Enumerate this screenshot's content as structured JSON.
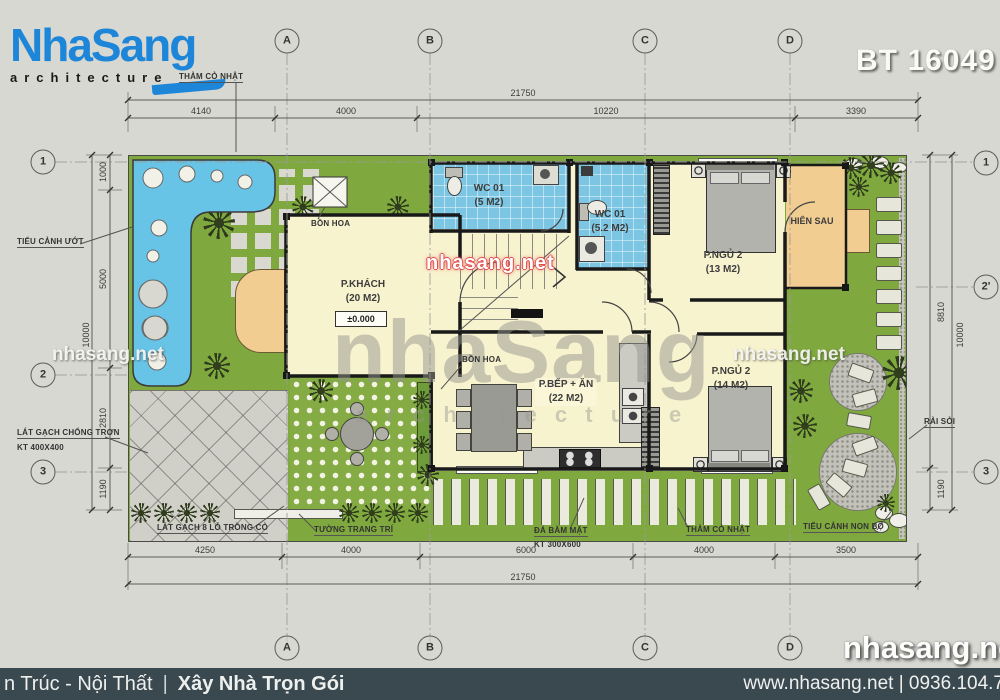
{
  "header": {
    "brand": "NhaSang",
    "brand_tagline": "architecture",
    "project_code": "BT 16049"
  },
  "grid": {
    "top": [
      "A",
      "B",
      "C",
      "D"
    ],
    "bottom": [
      "A",
      "B",
      "C",
      "D"
    ],
    "left": [
      "1",
      "2",
      "3"
    ],
    "right": [
      "1",
      "2'",
      "3"
    ]
  },
  "dimensions": {
    "top_overall": "21750",
    "top_segments": [
      "4140",
      "4000",
      "10220",
      "3390"
    ],
    "bottom_overall": "21750",
    "bottom_segments": [
      "4250",
      "4000",
      "6000",
      "4000",
      "3500"
    ],
    "left_overall": "10000",
    "left_segments": [
      "1000",
      "5000",
      "2810",
      "1190"
    ],
    "right_overall": "10000",
    "right_segments": [
      "8810",
      "1190"
    ]
  },
  "rooms": {
    "living": {
      "name": "P.KHÁCH",
      "area": "(20 M2)",
      "level": "±0.000"
    },
    "wc1": {
      "name": "WC 01",
      "area": "(5 M2)"
    },
    "wc2": {
      "name": "WC 01",
      "area": "(5.2 M2)"
    },
    "bed1": {
      "name": "P.NGỦ 2",
      "area": "(13 M2)"
    },
    "bed2": {
      "name": "P.NGỦ 2",
      "area": "(14 M2)"
    },
    "kitchen": {
      "name": "P.BẾP + ĂN",
      "area": "(22 M2)"
    },
    "porch": {
      "name": "HIÊN SAU"
    },
    "planter_top": {
      "name": "BỒN HOA"
    },
    "planter_kitchen": {
      "name": "BỒN HOA"
    }
  },
  "annotations": {
    "grass_top": "THẢM CỎ NHẬT",
    "wet_garden": "TIỂU CẢNH ƯỚT",
    "antislip_tile": "LÁT GẠCH CHỐNG TRƠN",
    "antislip_tile_size": "KT 400X400",
    "grass_brick": "LÁT GẠCH 8 LỖ TRỒNG CỎ",
    "deco_wall": "TƯỜNG TRANG TRÍ",
    "hammered_stone": "ĐÁ BĂM MẶT",
    "hammered_stone_size": "KT 300X600",
    "grass_bottom": "THẢM CỎ NHẬT",
    "rockery": "TIỂU CẢNH NON BỘ",
    "gravel": "RẢI SỎI"
  },
  "watermarks": {
    "center": "nhasang.net",
    "left": "nhasang.net",
    "right": "nhasang.net",
    "corner": "nhasang.net",
    "big": "nhaSang",
    "big_sub": "a r c h i t e c t u r e"
  },
  "footer": {
    "left_text": "n Trúc - Nội Thất",
    "divider": "|",
    "left_bold": "Xây Nhà Trọn Gói",
    "right_text": "www.nhasang.net | 0936.104.7"
  },
  "colors": {
    "brand_blue": "#1e86d8",
    "lawn": "#7fa83e",
    "water": "#68c4e7",
    "tile": "#7cc6e3",
    "floor": "#f8f3cf",
    "porch": "#f2cd92",
    "footer_bg": "#3a4850"
  }
}
